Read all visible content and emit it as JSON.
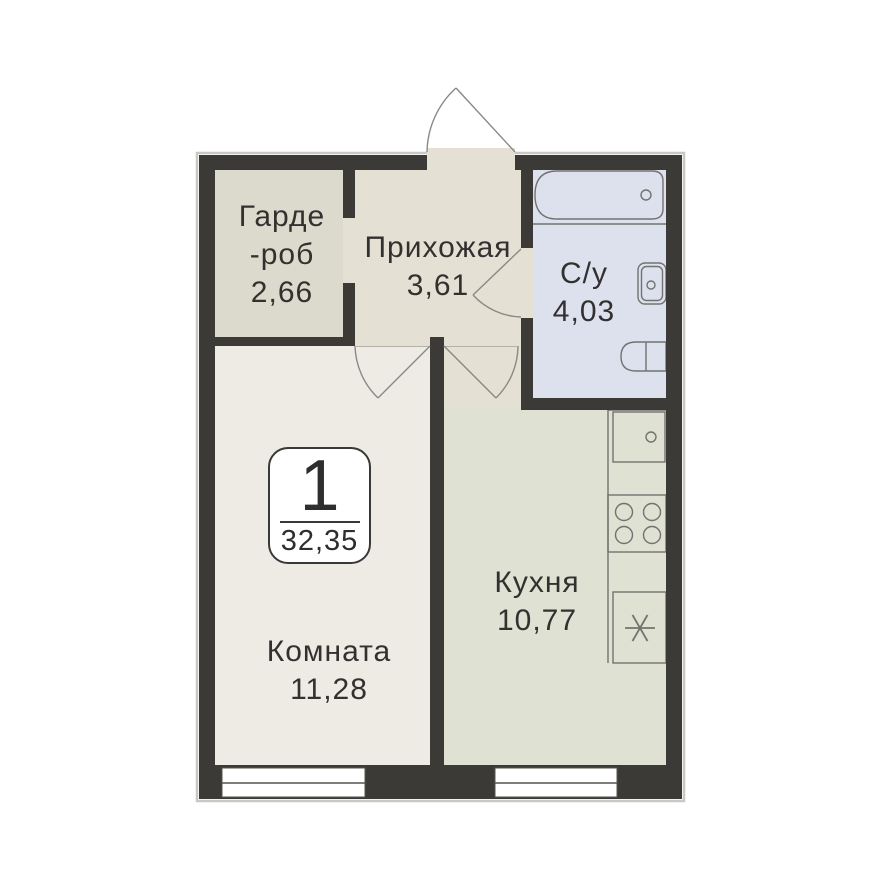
{
  "plan": {
    "type": "apartment-floor-plan",
    "badge": {
      "rooms_count": "1",
      "total_area": "32,35"
    },
    "rooms": {
      "wardrobe": {
        "label_line1": "Гарде",
        "label_line2": "-роб",
        "area": "2,66"
      },
      "hallway": {
        "label": "Прихожая",
        "area": "3,61"
      },
      "bathroom": {
        "label": "С/у",
        "area": "4,03"
      },
      "kitchen": {
        "label": "Кухня",
        "area": "10,77"
      },
      "living_room": {
        "label": "Комната",
        "area": "11,28"
      }
    },
    "fixtures": [
      "bathtub",
      "bathroom-sink",
      "toilet",
      "kitchen-sink",
      "stove",
      "fridge"
    ],
    "palette": {
      "wall": "#3b3a37",
      "wardrobe_floor": "#dbdacc",
      "hallway_floor": "#e4e1d4",
      "room_floor": "#edebe4",
      "kitchen_floor": "#dfe1d3",
      "bathroom_floor": "#dce1ed",
      "fixture_stroke": "#73726f",
      "door_arc": "#8a8984",
      "window_fill": "#ffffff",
      "text": "#333130",
      "outer_shadow": "#c9c8c4"
    }
  }
}
